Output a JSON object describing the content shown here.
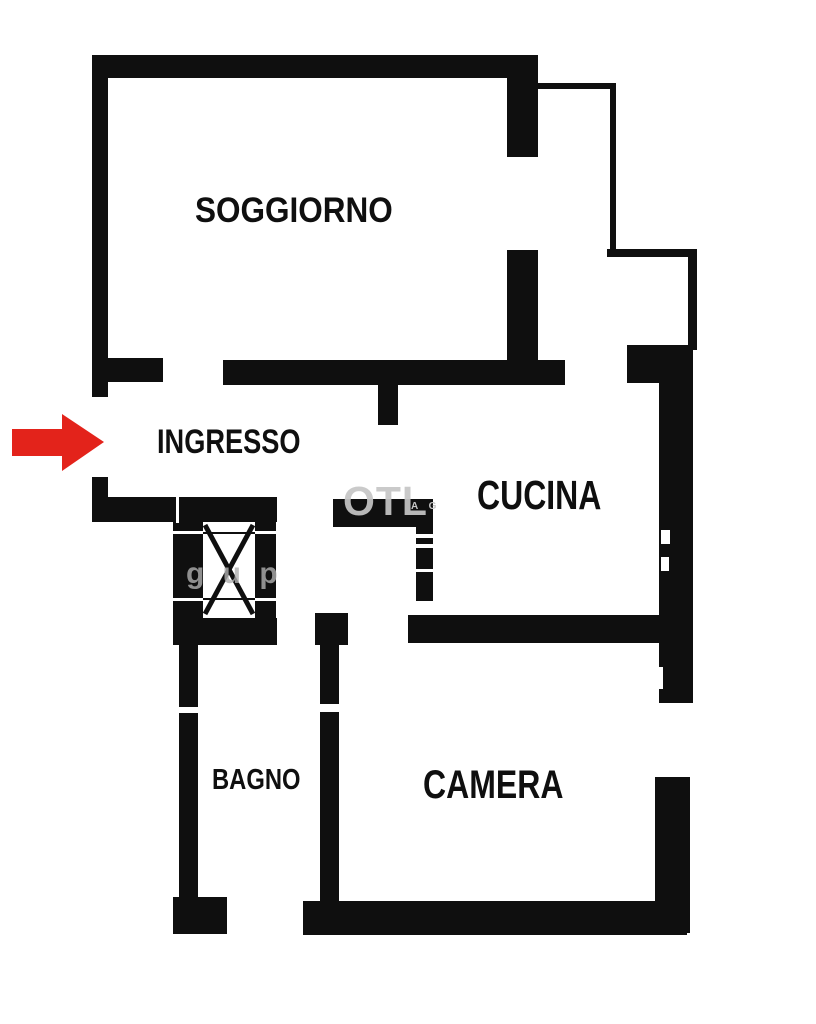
{
  "colors": {
    "ink": "#0f0f0f",
    "paper": "#ffffff",
    "arrow": "#e3231b",
    "watermark": "#c6c6c6",
    "watermark_soft": "#b0b0b0"
  },
  "rooms": {
    "soggiorno": {
      "label": "SOGGIORNO"
    },
    "ingresso": {
      "label": "INGRESSO"
    },
    "cucina": {
      "label": "CUCINA"
    },
    "bagno": {
      "label": "BAGNO"
    },
    "camera": {
      "label": "CAMERA"
    }
  },
  "watermark": {
    "large": "OTL",
    "small": "A G",
    "shaft": "g u p"
  }
}
